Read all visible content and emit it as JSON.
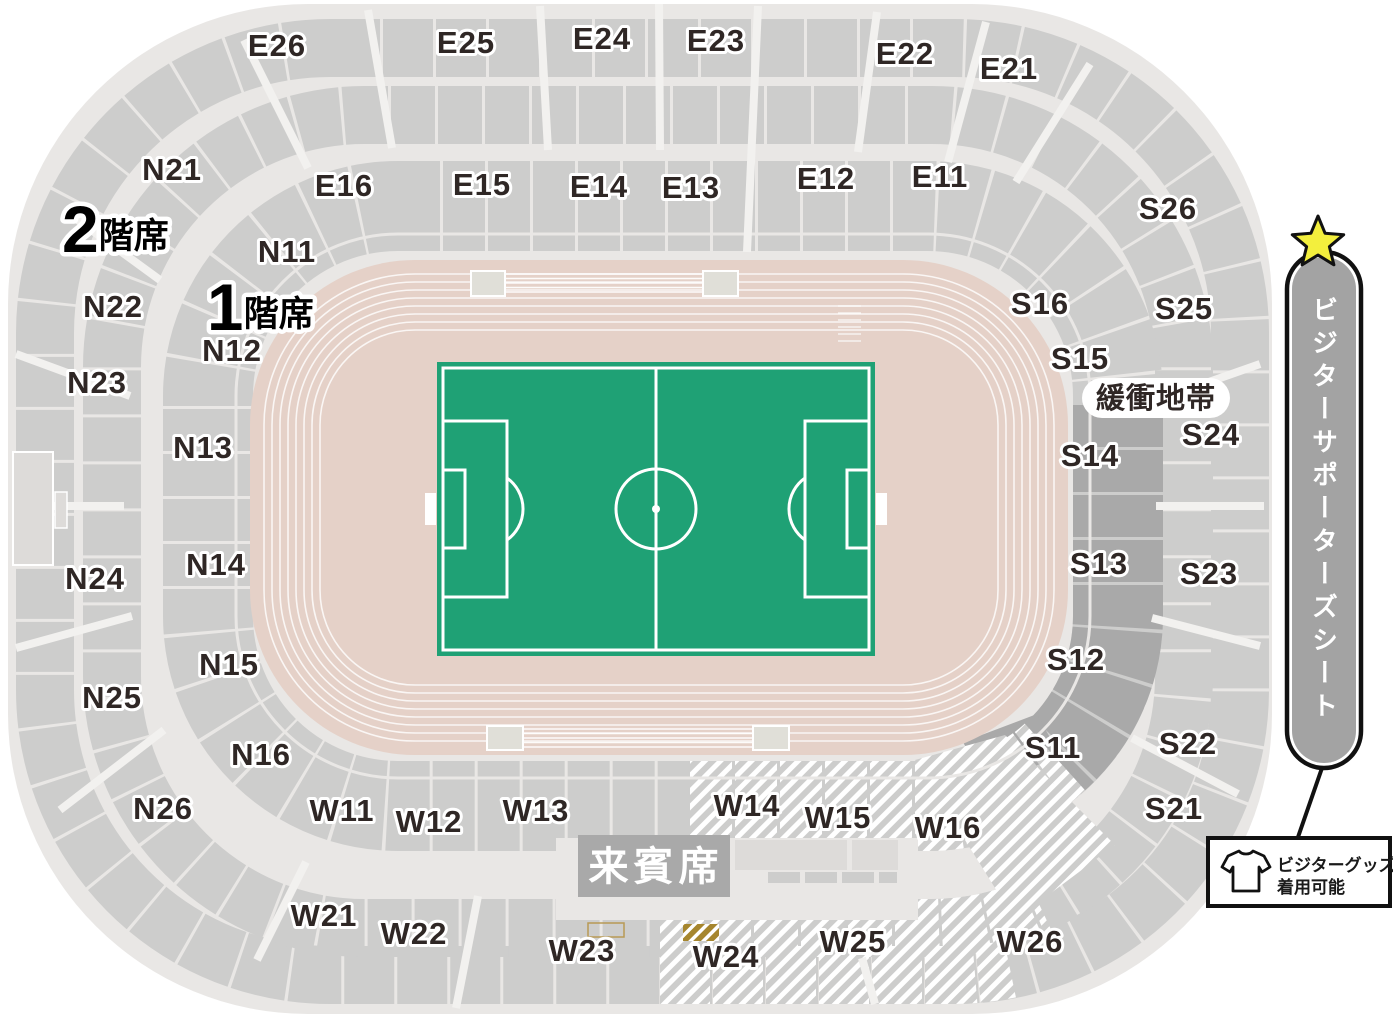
{
  "colors": {
    "pitch_green": "#1FA175",
    "track_pink": "#E5D1C8",
    "seat_gray": "#CDCDCC",
    "seat_dark_gray": "#A9A9A9",
    "concourse": "#E9E7E5",
    "star_yellow": "#F3EF3D",
    "gold": "#A6862E",
    "text_dark": "#2F2725",
    "vip_box_gray": "#A9A9A9",
    "banner_gray": "#A3A3A3"
  },
  "tiers": {
    "tier1": {
      "number": "1",
      "suffix": "階席"
    },
    "tier2": {
      "number": "2",
      "suffix": "階席"
    }
  },
  "sections": {
    "E11": "E11",
    "E12": "E12",
    "E13": "E13",
    "E14": "E14",
    "E15": "E15",
    "E16": "E16",
    "E21": "E21",
    "E22": "E22",
    "E23": "E23",
    "E24": "E24",
    "E25": "E25",
    "E26": "E26",
    "N11": "N11",
    "N12": "N12",
    "N13": "N13",
    "N14": "N14",
    "N15": "N15",
    "N16": "N16",
    "N21": "N21",
    "N22": "N22",
    "N23": "N23",
    "N24": "N24",
    "N25": "N25",
    "N26": "N26",
    "S11": "S11",
    "S12": "S12",
    "S13": "S13",
    "S14": "S14",
    "S15": "S15",
    "S16": "S16",
    "S21": "S21",
    "S22": "S22",
    "S23": "S23",
    "S24": "S24",
    "S25": "S25",
    "S26": "S26",
    "W11": "W11",
    "W12": "W12",
    "W13": "W13",
    "W14": "W14",
    "W15": "W15",
    "W16": "W16",
    "W21": "W21",
    "W22": "W22",
    "W23": "W23",
    "W24": "W24",
    "W25": "W25",
    "W26": "W26"
  },
  "labels": {
    "buffer_zone": "緩衝地帯",
    "vip_seats": "来賓席"
  },
  "visitor": {
    "banner": "ビジターサポーターズシート",
    "goods_line1": "ビジターグッズ",
    "goods_line2": "着用可能"
  }
}
